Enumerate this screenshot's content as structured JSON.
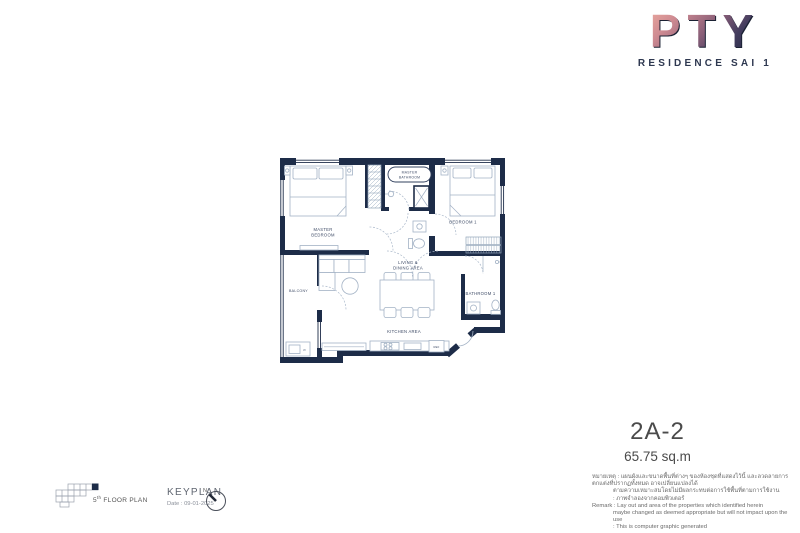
{
  "logo": {
    "brand": "PTY",
    "subtitle": "RESIDENCE SAI 1"
  },
  "unit": {
    "code": "2A-2",
    "area": "65.75 sq.m"
  },
  "floorplan": {
    "colors": {
      "wall": "#1d2c48",
      "furniture": "#a3b2c5",
      "label": "#3e4b66"
    },
    "labels": {
      "master_bedroom_1": "MASTER",
      "master_bedroom_2": "BEDROOM",
      "master_bathroom_1": "MASTER",
      "master_bathroom_2": "BATHROOM",
      "bedroom1": "BEDROOM 1",
      "bathroom1": "BATHROOM 1",
      "living_1": "LIVING &",
      "living_2": "DINING AREA",
      "kitchen": "KITCHEN AREA",
      "balcony": "BALCONY",
      "ref": "REF",
      "washer": "W"
    }
  },
  "remarks": {
    "thai_line1": "หมายเหตุ : แผนผังและขนาดพื้นที่ต่างๆ ของห้องชุดที่แสดงไว้นี้ และลวดลายการตกแต่งที่ปรากฏทั้งหมด อาจเปลี่ยนแปลงได้",
    "thai_line2": "ตามความเหมาะสมโดยไม่มีผลกระทบต่อการใช้พื้นที่ตามการใช้งาน",
    "thai_line3": ": ภาพจำลองจากคอมพิวเตอร์",
    "en_line1": "Remark :  Lay out and area of the properties which identified herein",
    "en_line2": "maybe changed as deemed appropriate but will not impact upon the use",
    "en_line3": ": This is computer graphic generated"
  },
  "footer": {
    "floor_number": "5",
    "floor_suffix": "th",
    "floor_text": " FLOOR PLAN",
    "keyplan_title": "KEYPLAN",
    "date_label": "Date : 09-01-2025",
    "compass_n": "N"
  }
}
